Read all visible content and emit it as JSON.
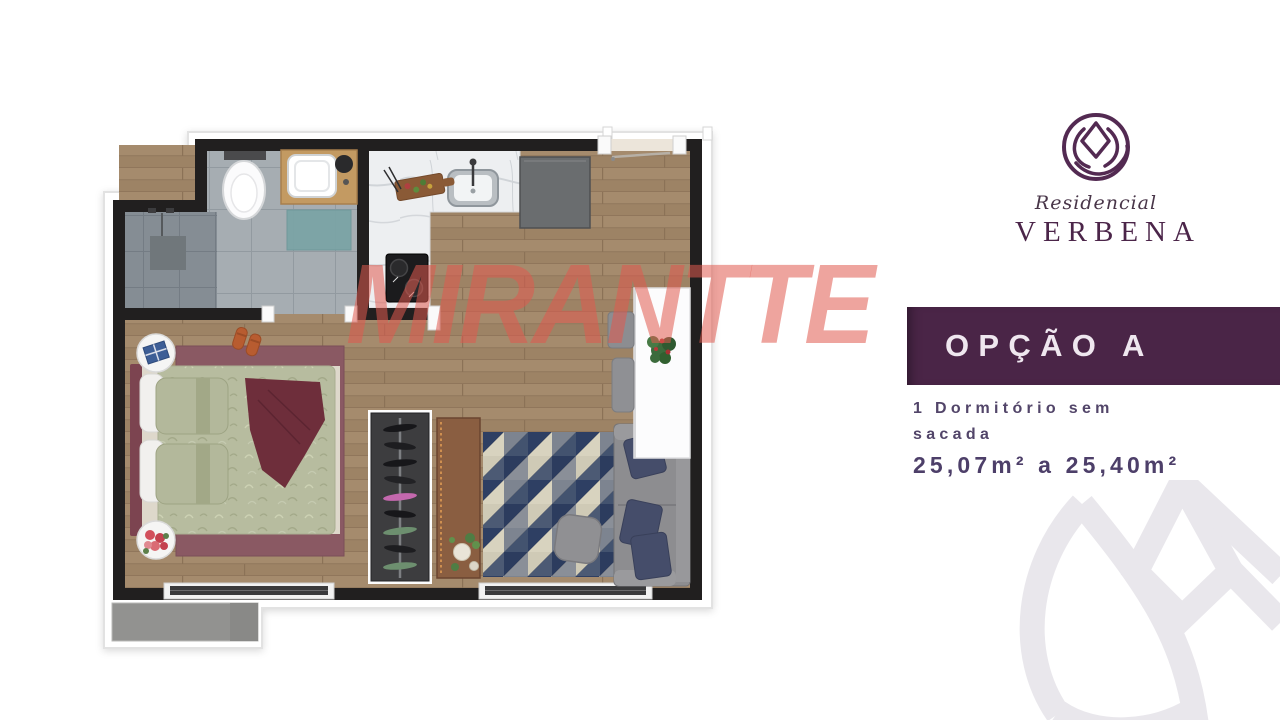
{
  "branding": {
    "residencial_label": "Residencial",
    "brand_name": "VERBENA",
    "logo_icon": "tulip-in-circle-icon",
    "logo_color": "#532a52"
  },
  "watermark": {
    "text": "MIRANTTE",
    "color": "#e05a4e"
  },
  "corner_watermark": {
    "icon": "tulip-outline-icon",
    "color": "#e9e7ec"
  },
  "option_panel": {
    "banner_label": "OPÇÃO A",
    "banner_bg": "#4a2547",
    "banner_text_color": "#efe7ef",
    "description_line1": "1 Dormitório sem",
    "description_line2": "sacada",
    "area_range": "25,07m² a 25,40m²",
    "text_color": "#524569"
  },
  "floorplan": {
    "wall_color": "#211f1f",
    "wood_floor_color": "#a2896c",
    "bathroom_tile_color": "#a6adb2",
    "shower_tile_color": "#858d94",
    "marble_counter_color": "#edeff1",
    "bedroom_rug_color": "#8a5963",
    "duvet_color": "#b7bc9f",
    "throw_color": "#6e2e3b",
    "living_rug_colors": [
      "#2e3f63",
      "#7d8490",
      "#d8d3bf",
      "#4c5a74"
    ],
    "sofa_color": "#8d8d90",
    "pillow_color": "#454d6a",
    "rooms": [
      "bathroom",
      "kitchen",
      "hallway",
      "bedroom",
      "living-room"
    ],
    "furniture": [
      "toilet",
      "vanity-sink",
      "shower",
      "bath-mat",
      "kitchen-sink",
      "cutting-board",
      "cooktop",
      "refrigerator",
      "entry-door",
      "double-bed",
      "bedroom-rug",
      "nightstands",
      "slippers",
      "wardrobe",
      "sideboard",
      "geometric-rug",
      "ottoman",
      "sofa",
      "desk",
      "desk-plant",
      "bench",
      "stool",
      "bedroom-window",
      "living-window",
      "service-ledge"
    ]
  }
}
